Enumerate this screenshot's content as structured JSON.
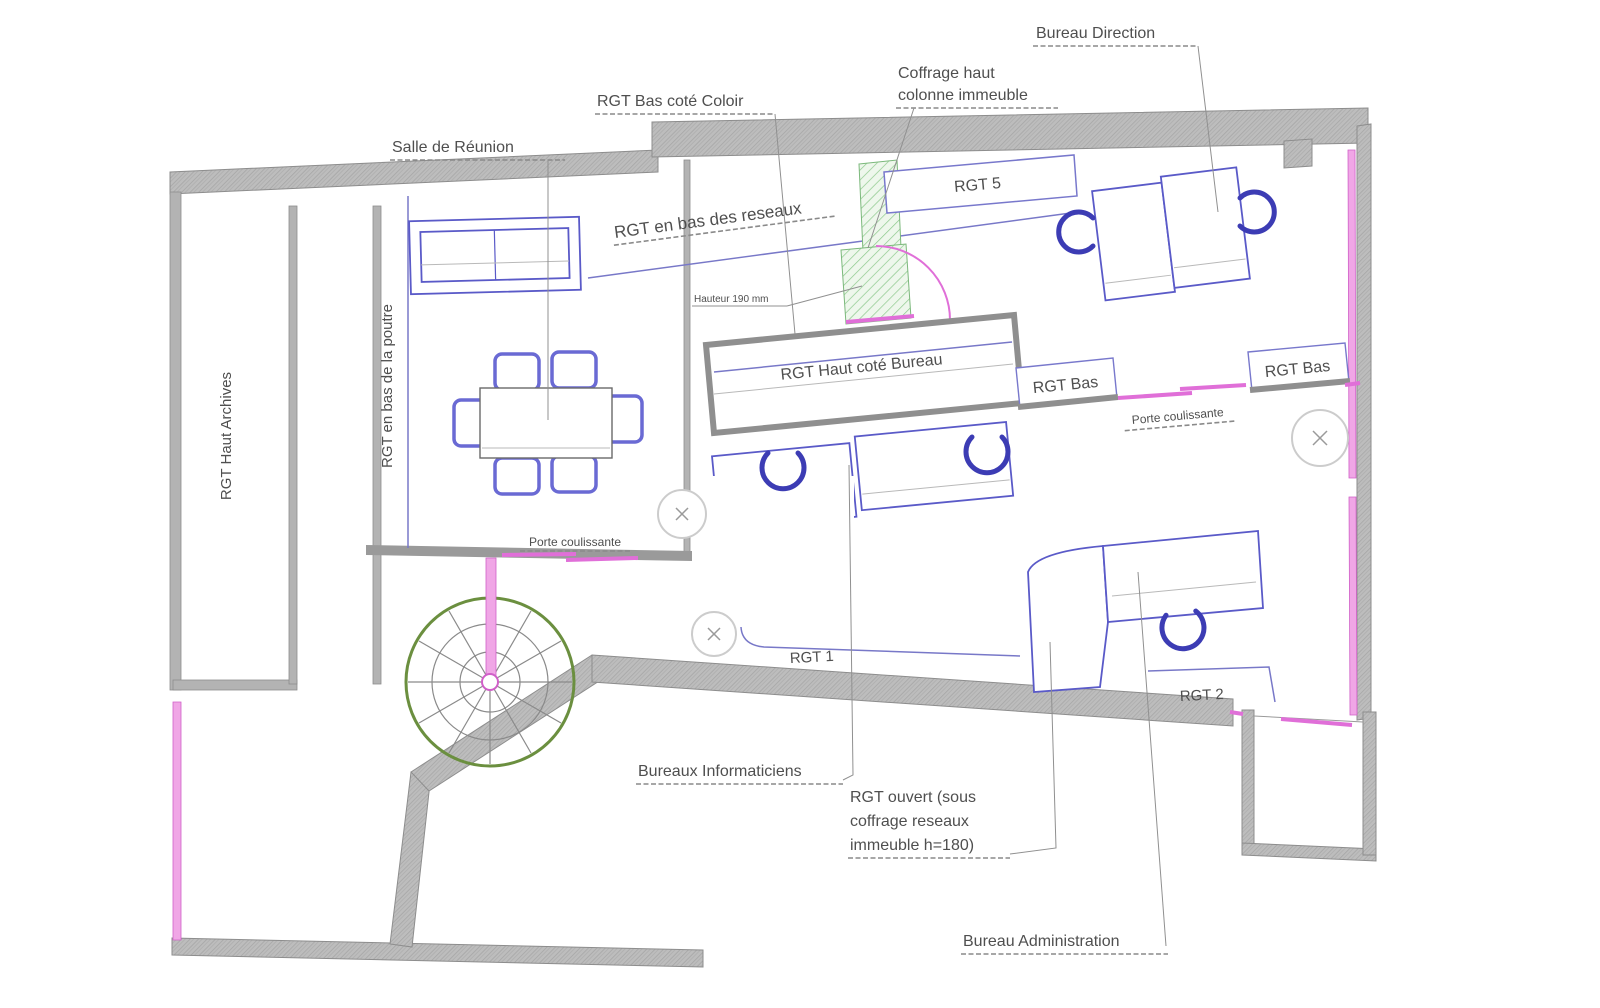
{
  "document": {
    "type": "floor-plan",
    "language": "fr"
  },
  "colors": {
    "wall-stroke": "#8d8d8d",
    "wall-solid": "#b3b3b3",
    "furniture-blue": "#5a5ac8",
    "chair-blue": "#3c3cb4",
    "tray-blue": "#7878c8",
    "door-magenta": "#e06fd8",
    "window-magenta": "#f0a6e6",
    "stair-green": "#6b8f3f",
    "label-gray": "#4f4f4f",
    "leader-gray": "#8a8a8a",
    "outlet-gray": "#cccccc"
  },
  "labels": {
    "bureau_direction": "Bureau Direction",
    "coffrage_haut_1": "Coffrage haut",
    "coffrage_haut_2": "colonne immeuble",
    "rgt_bas_coloir": "RGT Bas coté Coloir",
    "salle_de_reunion": "Salle de Réunion",
    "rgt_en_bas_reseaux": "RGT en bas des reseaux",
    "rgt_5": "RGT 5",
    "hauteur": "Hauteur 190 mm",
    "rgt_haut_cote_bureau": "RGT Haut coté Bureau",
    "rgt_bas_left": "RGT Bas",
    "rgt_bas_right": "RGT Bas",
    "porte_coulissante_right": "Porte coulissante",
    "rgt_haut_archives": "RGT Haut Archives",
    "rgt_en_bas_poutre": "RGT en bas de la poutre",
    "porte_coulissante_bottom": "Porte coulissante",
    "rgt_1": "RGT 1",
    "rgt_2": "RGT 2",
    "bureaux_informaticiens": "Bureaux Informaticiens",
    "rgt_ouvert_1": "RGT ouvert (sous",
    "rgt_ouvert_2": "coffrage reseaux",
    "rgt_ouvert_3": "immeuble h=180)",
    "bureau_administration": "Bureau Administration"
  }
}
